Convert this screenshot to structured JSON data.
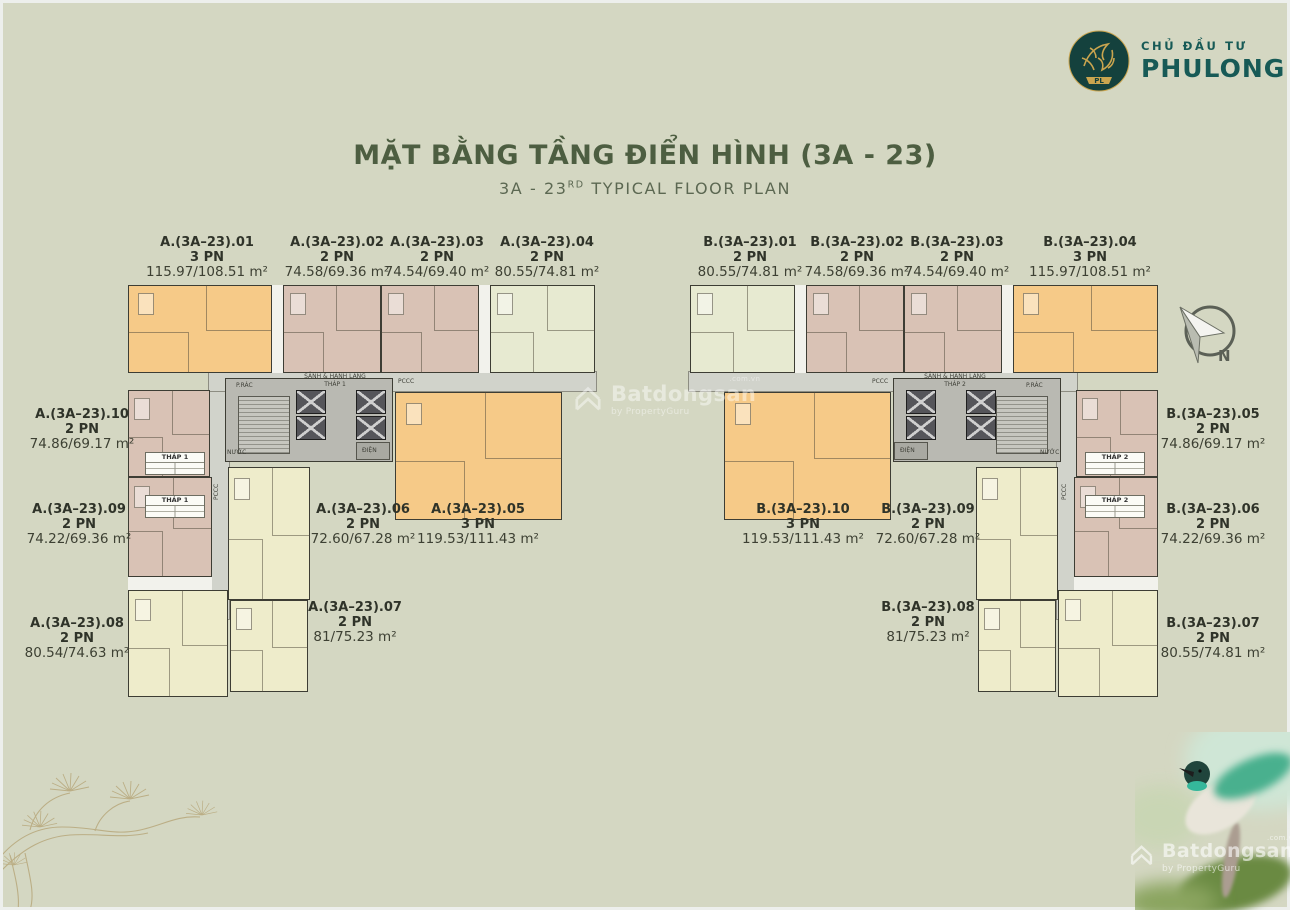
{
  "header": {
    "developer_label": "CHỦ ĐẦU TƯ",
    "developer_name": "PHULONG",
    "logo_monogram": "PL",
    "title": "MẶT BẰNG TẦNG ĐIỂN HÌNH (3A - 23)",
    "subtitle_prefix": "3A - 23",
    "subtitle_sup": "RD",
    "subtitle_rest": " TYPICAL FLOOR PLAN"
  },
  "compass": {
    "label": "N"
  },
  "watermark": {
    "brand": "Batdongsan",
    "byline": "by PropertyGuru",
    "domain": ".com.vn"
  },
  "plan": {
    "corridor_hall": "SẢNH & HÀNH LANG",
    "tower1": "THÁP 1",
    "tower2": "THÁP 2",
    "fire_label": "PCCC",
    "electric_label": "ĐIỆN",
    "water_label": "NƯỚC",
    "trash_label": "P.RÁC"
  },
  "apartments": [
    {
      "id": "A01",
      "name": "A.(3A–23).01",
      "bedrooms": "3 PN",
      "area": "115.97/108.51 m²"
    },
    {
      "id": "A02",
      "name": "A.(3A–23).02",
      "bedrooms": "2 PN",
      "area": "74.58/69.36 m²"
    },
    {
      "id": "A03",
      "name": "A.(3A–23).03",
      "bedrooms": "2 PN",
      "area": "74.54/69.40 m²"
    },
    {
      "id": "A04",
      "name": "A.(3A–23).04",
      "bedrooms": "2 PN",
      "area": "80.55/74.81 m²"
    },
    {
      "id": "A05",
      "name": "A.(3A–23).05",
      "bedrooms": "3 PN",
      "area": "119.53/111.43 m²"
    },
    {
      "id": "A06",
      "name": "A.(3A–23).06",
      "bedrooms": "2 PN",
      "area": "72.60/67.28 m²"
    },
    {
      "id": "A07",
      "name": "A.(3A–23).07",
      "bedrooms": "2 PN",
      "area": "81/75.23 m²"
    },
    {
      "id": "A08",
      "name": "A.(3A–23).08",
      "bedrooms": "2 PN",
      "area": "80.54/74.63 m²"
    },
    {
      "id": "A09",
      "name": "A.(3A–23).09",
      "bedrooms": "2 PN",
      "area": "74.22/69.36 m²"
    },
    {
      "id": "A10",
      "name": "A.(3A–23).10",
      "bedrooms": "2 PN",
      "area": "74.86/69.17 m²"
    },
    {
      "id": "B01",
      "name": "B.(3A–23).01",
      "bedrooms": "2 PN",
      "area": "80.55/74.81 m²"
    },
    {
      "id": "B02",
      "name": "B.(3A–23).02",
      "bedrooms": "2 PN",
      "area": "74.58/69.36 m²"
    },
    {
      "id": "B03",
      "name": "B.(3A–23).03",
      "bedrooms": "2 PN",
      "area": "74.54/69.40 m²"
    },
    {
      "id": "B04",
      "name": "B.(3A–23).04",
      "bedrooms": "3 PN",
      "area": "115.97/108.51 m²"
    },
    {
      "id": "B05",
      "name": "B.(3A–23).05",
      "bedrooms": "2 PN",
      "area": "74.86/69.17 m²"
    },
    {
      "id": "B06",
      "name": "B.(3A–23).06",
      "bedrooms": "2 PN",
      "area": "74.22/69.36 m²"
    },
    {
      "id": "B07",
      "name": "B.(3A–23).07",
      "bedrooms": "2 PN",
      "area": "80.55/74.81 m²"
    },
    {
      "id": "B08",
      "name": "B.(3A–23).08",
      "bedrooms": "2 PN",
      "area": "81/75.23 m²"
    },
    {
      "id": "B09",
      "name": "B.(3A–23).09",
      "bedrooms": "2 PN",
      "area": "72.60/67.28 m²"
    },
    {
      "id": "B10",
      "name": "B.(3A–23).10",
      "bedrooms": "3 PN",
      "area": "119.53/111.43 m²"
    }
  ],
  "colors": {
    "background": "#d4d7c2",
    "title": "#4d5e41",
    "brand_teal": "#175a56",
    "unit_orange": "#f6ca88",
    "unit_tan": "#d9c2b5",
    "unit_green": "#e7ead1",
    "unit_yellow": "#eeeccb",
    "core_gray": "#b9b9b2"
  }
}
